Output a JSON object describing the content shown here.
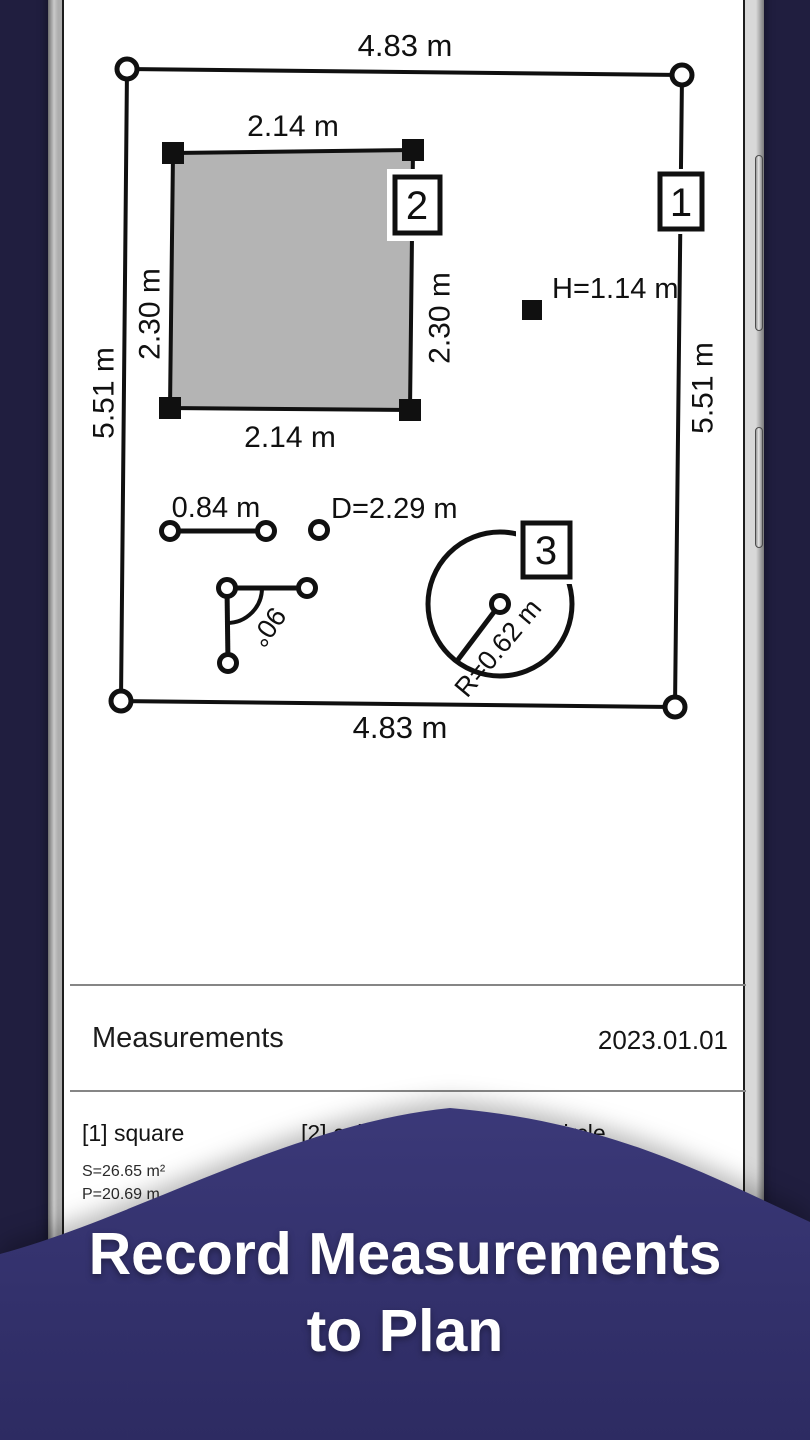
{
  "headline": {
    "line1": "Record Measurements",
    "line2": "to Plan"
  },
  "plan": {
    "outer": {
      "top_dim": "4.83 m",
      "bottom_dim": "4.83 m",
      "left_dim": "5.51 m",
      "right_dim": "5.51 m",
      "marker": "1"
    },
    "square": {
      "top_dim": "2.14 m",
      "bottom_dim": "2.14 m",
      "left_dim": "2.30 m",
      "right_dim": "2.30 m",
      "marker": "2"
    },
    "height_point_label": "H=1.14 m",
    "segment_label": "0.84 m",
    "diameter_point_label": "D=2.29 m",
    "angle_label": "90°",
    "circle": {
      "radius_label": "R=0.62 m",
      "marker": "3"
    }
  },
  "measurements": {
    "title": "Measurements",
    "date": "2023.01.01",
    "items": [
      {
        "label": "[1] square",
        "value1": "S=26.65 m²",
        "value2": "P=20.69 m"
      },
      {
        "label": "[2] cube",
        "value1": "V=7.04 m³",
        "value2": ""
      },
      {
        "label": "[3] circle",
        "value1": "",
        "value2": ""
      }
    ]
  },
  "colors": {
    "background_navy": "#201e3f",
    "wave_top": "#3b3979",
    "wave_bottom": "#2d2b62",
    "room_fill": "#b4b4b4",
    "line_ink": "#101010"
  }
}
